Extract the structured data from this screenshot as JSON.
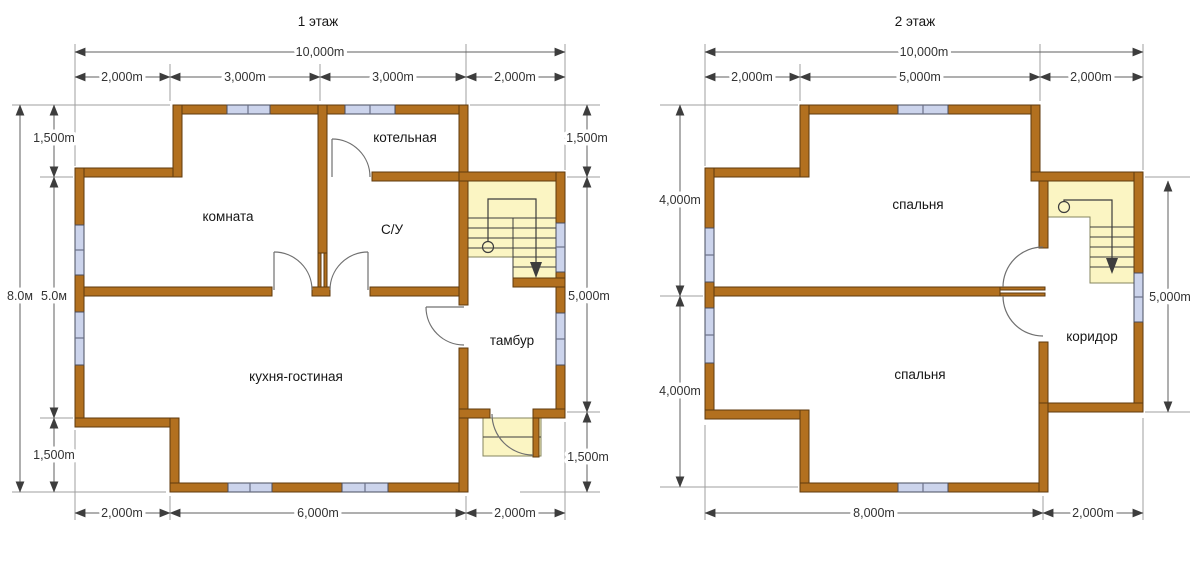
{
  "colors": {
    "wall": "#b2701f",
    "wall_border": "#5f3a0e",
    "window": "#ccd4ec",
    "stair_area": "#fbf5c3",
    "dim_line": "#5f5f5f"
  },
  "floor1": {
    "title": "1 этаж",
    "rooms": {
      "room": "комната",
      "boiler": "котельная",
      "bathroom": "С/У",
      "vestibule": "тамбур",
      "kitchen_living": "кухня-гостиная"
    },
    "dims": {
      "total_width": "10,000m",
      "top_segments": [
        "2,000m",
        "3,000m",
        "3,000m",
        "2,000m"
      ],
      "left_total": "8.0м",
      "left_segments": [
        "1,500m",
        "5.0м",
        "1,500m"
      ],
      "right_segments": [
        "1,500m",
        "5,000m",
        "1,500m"
      ],
      "bottom_segments": [
        "2,000m",
        "6,000m",
        "2,000m"
      ]
    }
  },
  "floor2": {
    "title": "2 этаж",
    "rooms": {
      "bedroom_top": "спальня",
      "bedroom_bottom": "спальня",
      "corridor": "коридор"
    },
    "dims": {
      "total_width": "10,000m",
      "top_segments": [
        "2,000m",
        "5,000m",
        "2,000m"
      ],
      "left_segments": [
        "4,000m",
        "4,000m"
      ],
      "right_segment": "5,000m",
      "bottom_segments": [
        "8,000m",
        "2,000m"
      ]
    }
  }
}
